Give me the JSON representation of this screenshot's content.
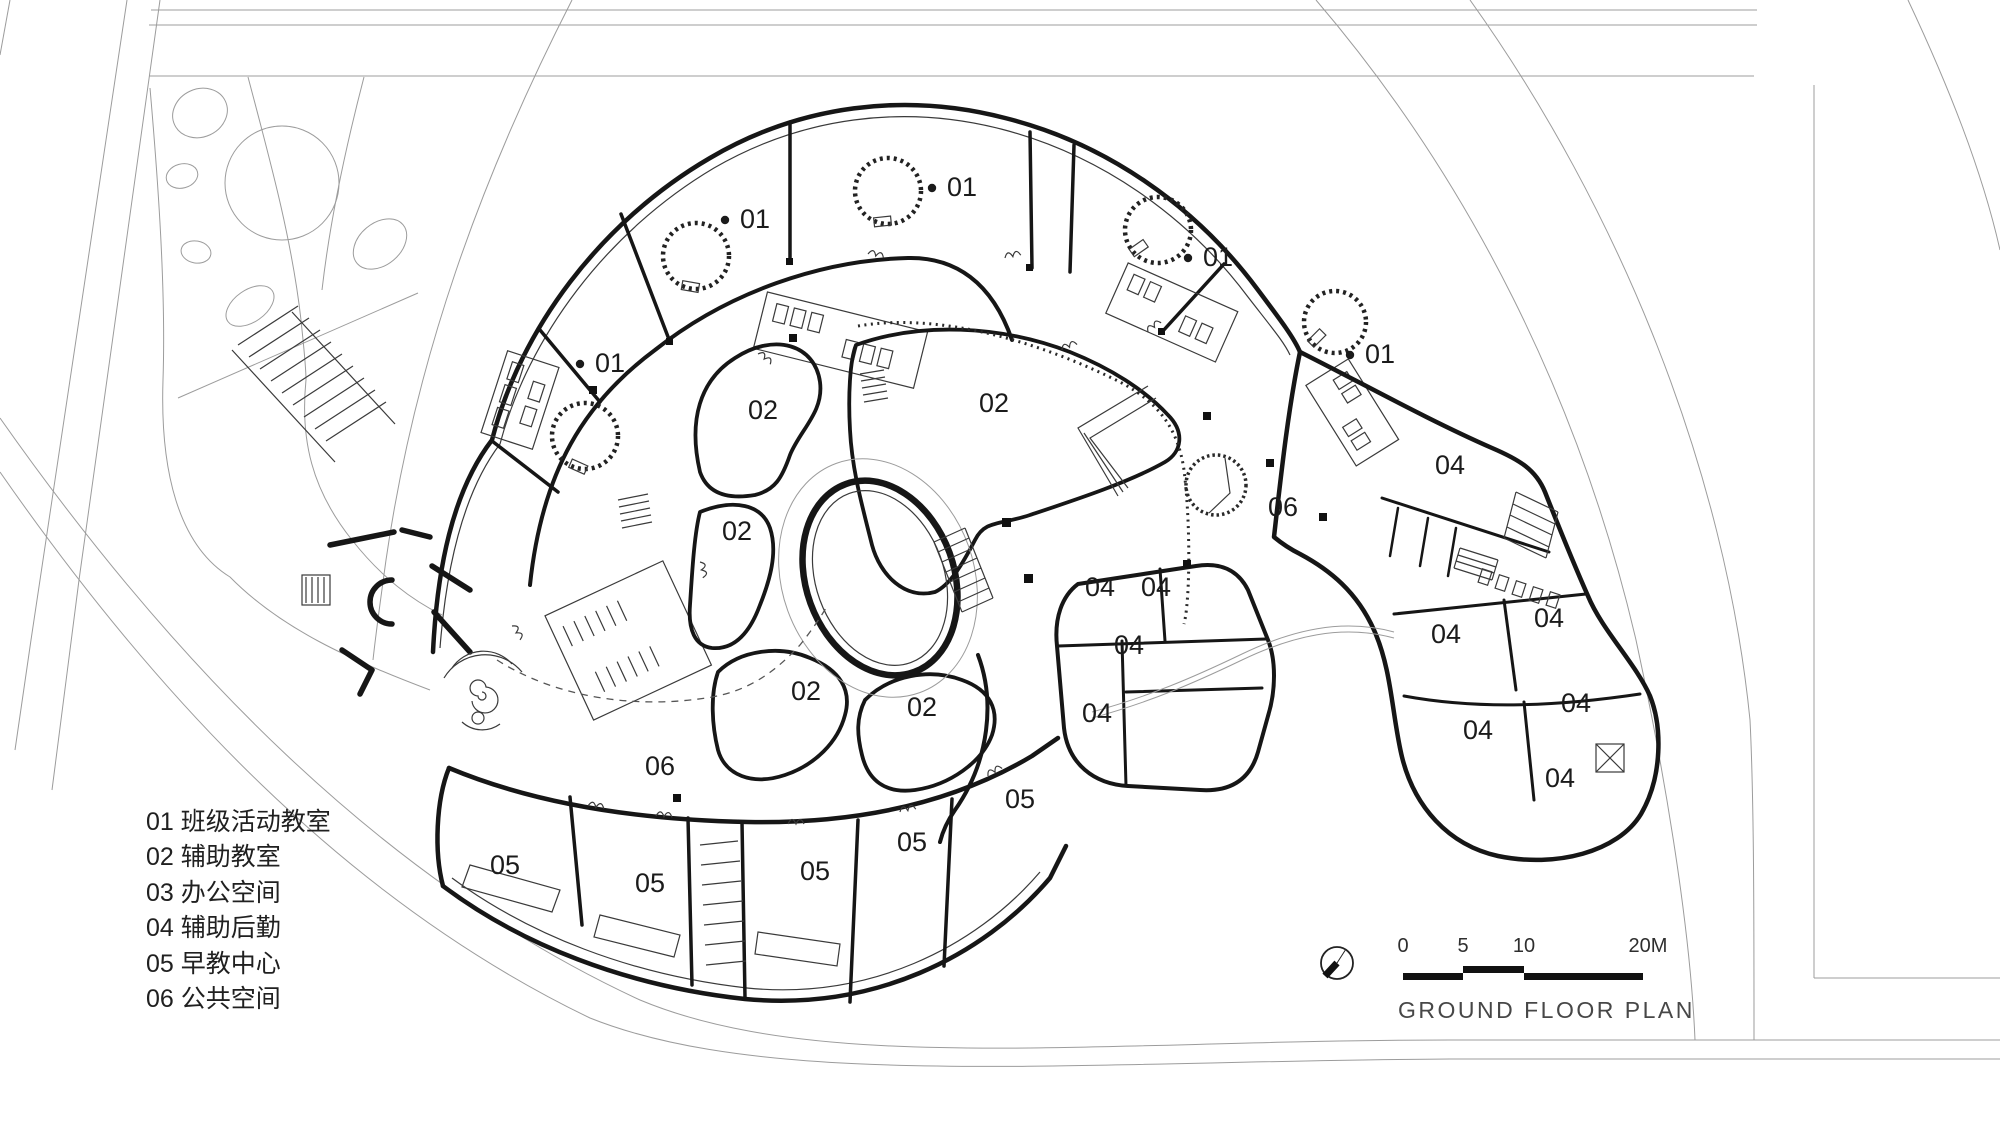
{
  "page": {
    "title": "GROUND FLOOR PLAN"
  },
  "colors": {
    "wall": "#161616",
    "site_line": "#9c9c9c",
    "label_text": "#1b1b1b",
    "title_text": "#474747"
  },
  "legend": {
    "items": [
      {
        "code": "01",
        "name": "班级活动教室"
      },
      {
        "code": "02",
        "name": "辅助教室"
      },
      {
        "code": "03",
        "name": "办公空间"
      },
      {
        "code": "04",
        "name": "辅助后勤"
      },
      {
        "code": "05",
        "name": "早教中心"
      },
      {
        "code": "06",
        "name": "公共空间"
      }
    ]
  },
  "scale_bar": {
    "ticks": [
      {
        "label": "0",
        "x": 1403
      },
      {
        "label": "5",
        "x": 1463
      },
      {
        "label": "10",
        "x": 1524
      },
      {
        "label": "20M",
        "x": 1648
      }
    ]
  },
  "plan": {
    "room_labels": [
      {
        "code": "01",
        "x": 610,
        "y": 372,
        "bullet": true
      },
      {
        "code": "01",
        "x": 755,
        "y": 228,
        "bullet": true
      },
      {
        "code": "01",
        "x": 962,
        "y": 196,
        "bullet": true
      },
      {
        "code": "01",
        "x": 1218,
        "y": 266,
        "bullet": true
      },
      {
        "code": "01",
        "x": 1380,
        "y": 363,
        "bullet": true
      },
      {
        "code": "02",
        "x": 763,
        "y": 419,
        "bullet": false
      },
      {
        "code": "02",
        "x": 994,
        "y": 412,
        "bullet": false
      },
      {
        "code": "02",
        "x": 737,
        "y": 540,
        "bullet": false
      },
      {
        "code": "02",
        "x": 806,
        "y": 700,
        "bullet": false
      },
      {
        "code": "02",
        "x": 922,
        "y": 716,
        "bullet": false
      },
      {
        "code": "04",
        "x": 1450,
        "y": 474,
        "bullet": false
      },
      {
        "code": "04",
        "x": 1100,
        "y": 596,
        "bullet": false
      },
      {
        "code": "04",
        "x": 1156,
        "y": 596,
        "bullet": false
      },
      {
        "code": "04",
        "x": 1129,
        "y": 654,
        "bullet": false
      },
      {
        "code": "04",
        "x": 1097,
        "y": 722,
        "bullet": false
      },
      {
        "code": "04",
        "x": 1446,
        "y": 643,
        "bullet": false
      },
      {
        "code": "04",
        "x": 1549,
        "y": 627,
        "bullet": false
      },
      {
        "code": "04",
        "x": 1576,
        "y": 712,
        "bullet": false
      },
      {
        "code": "04",
        "x": 1478,
        "y": 739,
        "bullet": false
      },
      {
        "code": "04",
        "x": 1560,
        "y": 787,
        "bullet": false
      },
      {
        "code": "05",
        "x": 505,
        "y": 874,
        "bullet": false
      },
      {
        "code": "05",
        "x": 650,
        "y": 892,
        "bullet": false
      },
      {
        "code": "05",
        "x": 815,
        "y": 880,
        "bullet": false
      },
      {
        "code": "05",
        "x": 912,
        "y": 851,
        "bullet": false
      },
      {
        "code": "05",
        "x": 1020,
        "y": 808,
        "bullet": false
      },
      {
        "code": "06",
        "x": 1283,
        "y": 516,
        "bullet": false
      },
      {
        "code": "06",
        "x": 660,
        "y": 775,
        "bullet": false
      }
    ]
  }
}
